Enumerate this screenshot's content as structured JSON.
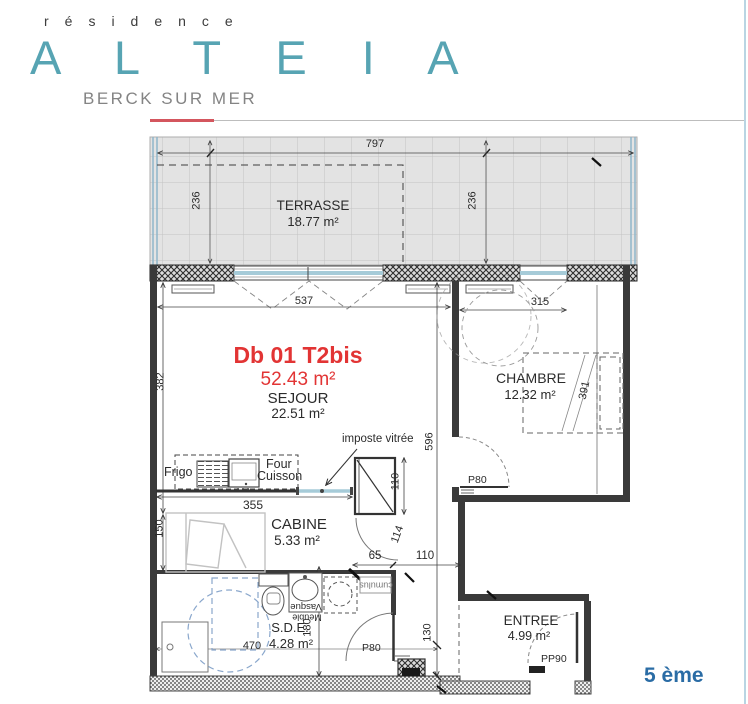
{
  "header": {
    "residence": "résidence",
    "name": "A L T E I A",
    "city": "BERCK SUR MER"
  },
  "unit": {
    "code": "Db 01 T2bis",
    "total_area": "52.43 m²"
  },
  "rooms": {
    "terrasse": {
      "name": "TERRASSE",
      "area": "18.77 m²"
    },
    "sejour": {
      "name": "SEJOUR",
      "area": "22.51 m²"
    },
    "chambre": {
      "name": "CHAMBRE",
      "area": "12.32 m²"
    },
    "cabine": {
      "name": "CABINE",
      "area": "5.33 m²"
    },
    "sde": {
      "name": "S.D.E.",
      "area": "4.28 m²"
    },
    "entree": {
      "name": "ENTREE",
      "area": "4.99 m²"
    }
  },
  "fixtures": {
    "frigo": "Frigo",
    "four": "Four",
    "cuisson": "Cuisson",
    "imposte_vitree": "imposte vitrée",
    "meuble": "Meuble",
    "vasque": "Vasque",
    "cumulus": "cumulus"
  },
  "doors": {
    "chambre": "P80",
    "sde": "P80",
    "entree": "PP90"
  },
  "dims": {
    "terrace_width": "797",
    "terrace_depth_left": "236",
    "terrace_depth_right": "236",
    "sejour_width": "537",
    "chambre_window": "315",
    "sejour_depth": "382",
    "core_depth": "596",
    "bed_length": "391",
    "kitchen_width": "355",
    "cabine_depth": "150",
    "column_height": "110",
    "door_swing": "114",
    "passage_65": "65",
    "passage_110": "110",
    "entree_niche": "130",
    "sde_depth": "180",
    "sde_width": "470"
  },
  "page": {
    "floor_label": "5 ème"
  },
  "colors": {
    "brand_teal": "#57a4b3",
    "accent_red": "#e23434",
    "floor_blue": "#2a6ca5",
    "glass_blue": "#a6cbd8",
    "ruler_red": "#d4565e"
  }
}
